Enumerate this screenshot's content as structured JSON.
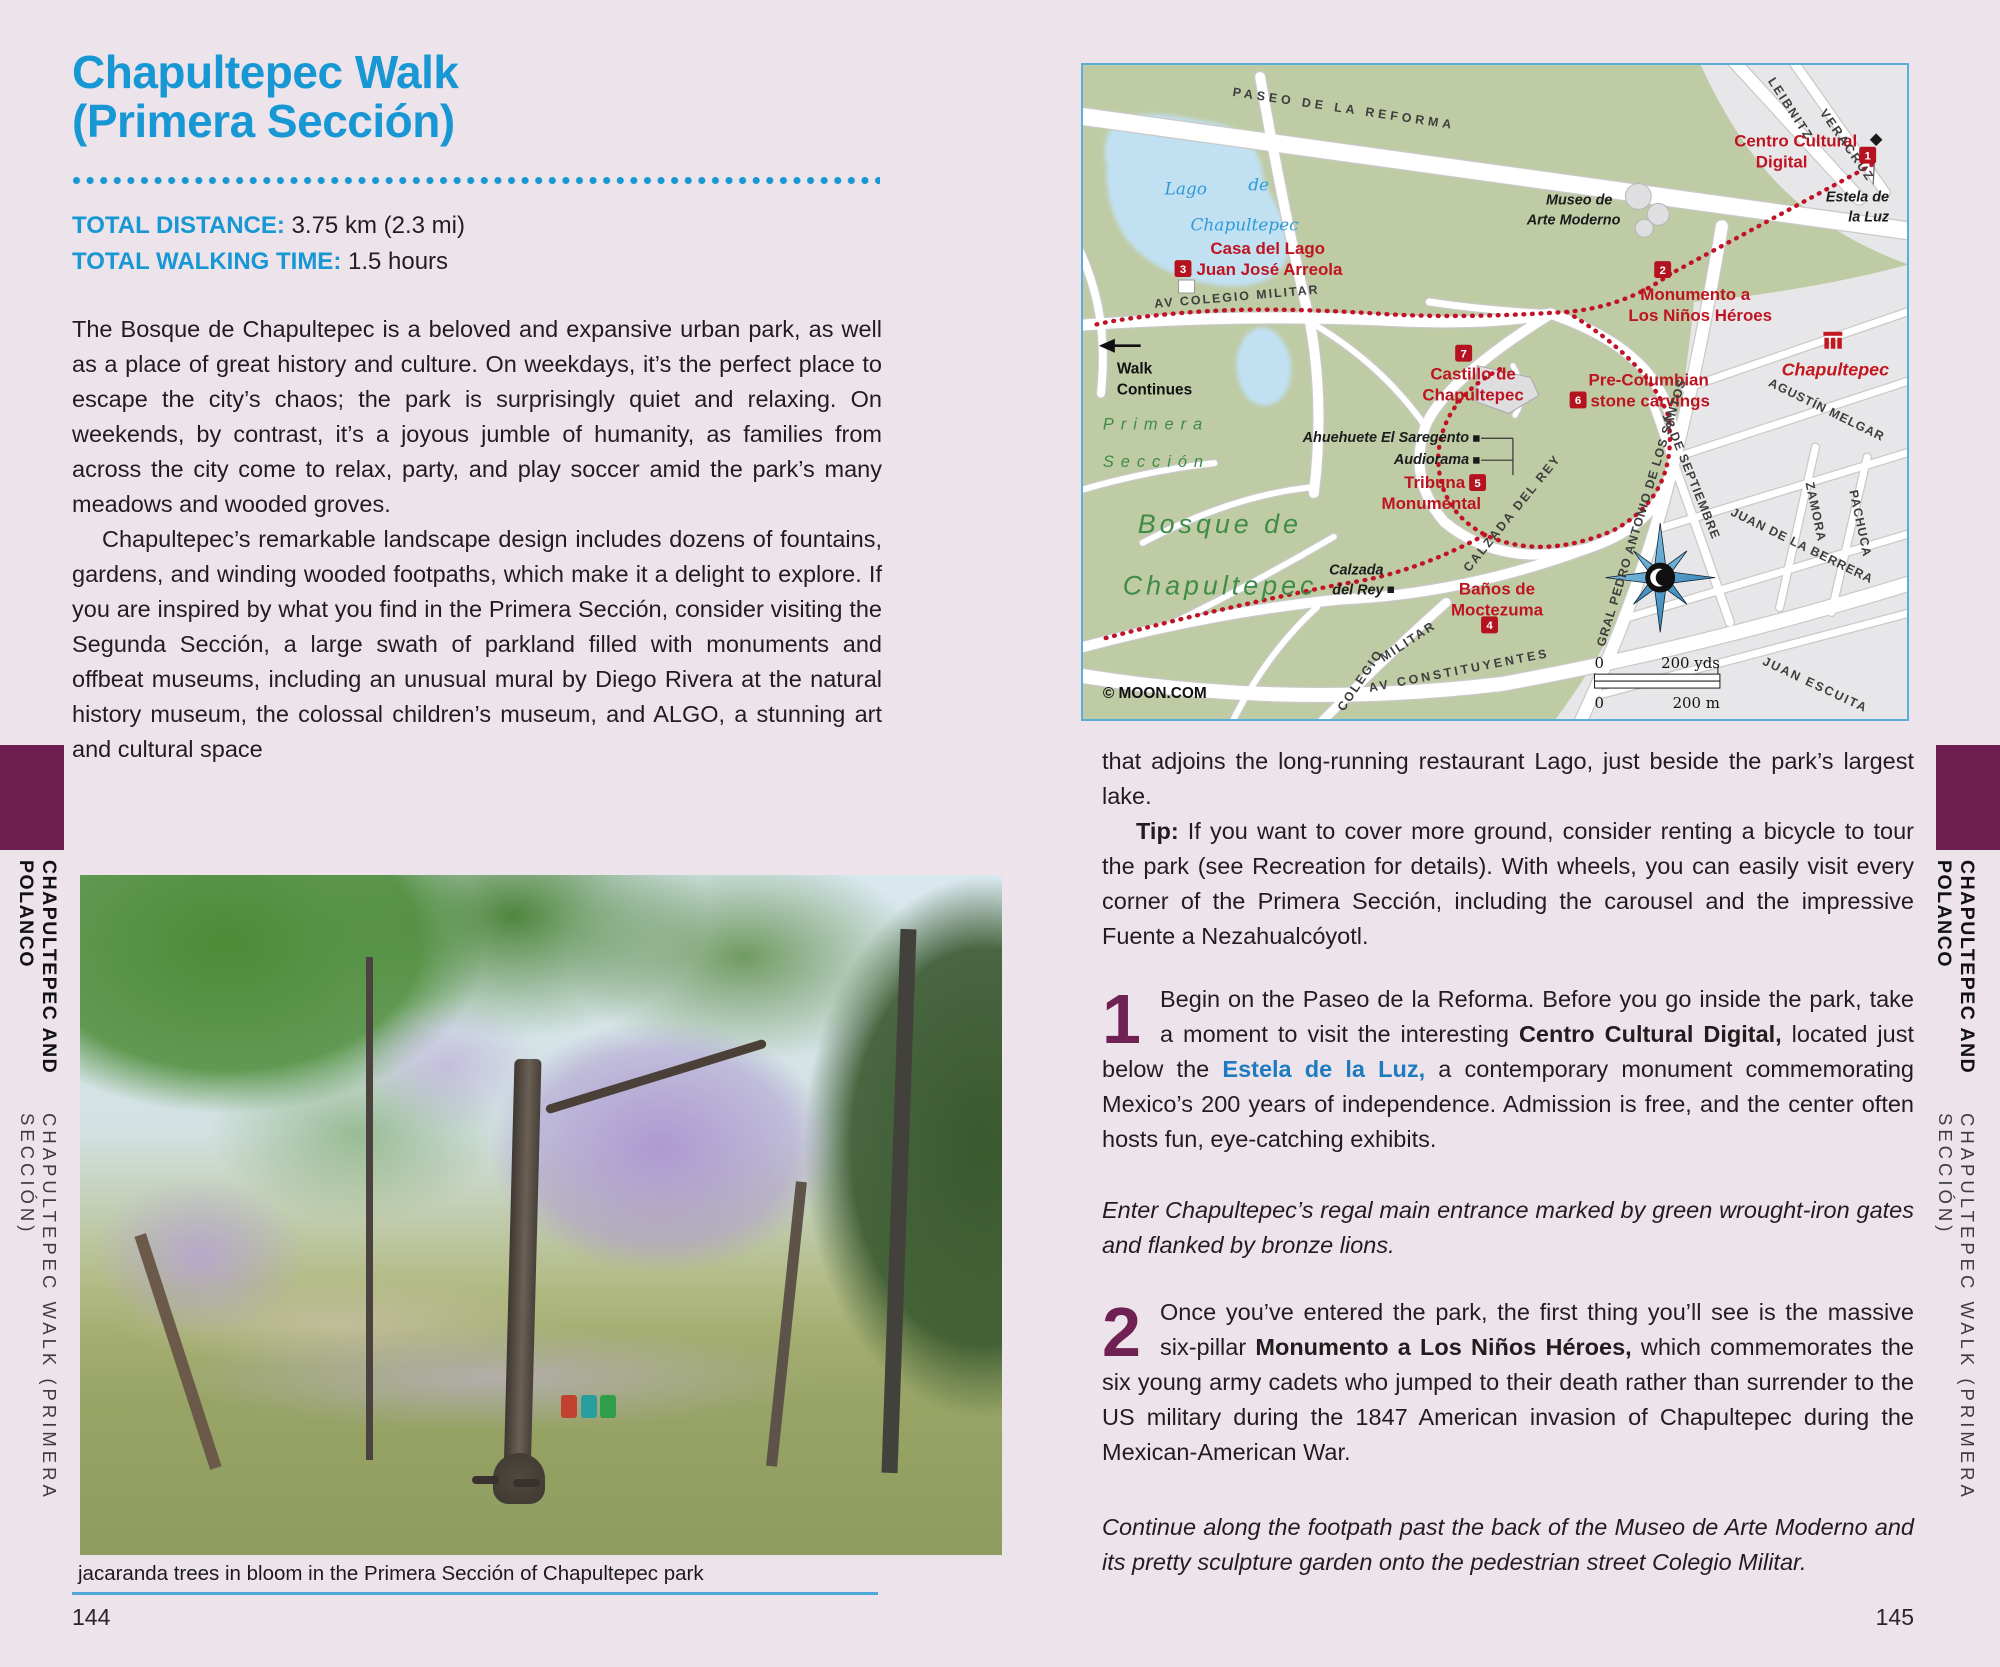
{
  "colors": {
    "page_background": "#EDE4EB",
    "accent_blue": "#1797D3",
    "link_blue": "#1E7BBF",
    "plum": "#6E1F52",
    "map_label_red": "#BE1421",
    "map_route_red": "#C01327",
    "map_border_blue": "#58AFD8",
    "map_park_green": "#BFCBA4",
    "caption_rule_blue": "#4FA8D8"
  },
  "band": {
    "bold": "CHAPULTEPEC AND POLANCO",
    "light": "CHAPULTEPEC WALK (PRIMERA SECCIÓN)"
  },
  "left": {
    "title1": "Chapultepec Walk",
    "title2": "(Primera Sección)",
    "stats": [
      {
        "label": "TOTAL DISTANCE:",
        "value": " 3.75 km (2.3 mi)"
      },
      {
        "label": "TOTAL WALKING TIME:",
        "value": " 1.5 hours"
      }
    ],
    "para1": "The Bosque de Chapultepec is a beloved and expansive urban park, as well as a place of great history and culture. On weekdays, it’s the perfect place to escape the city’s chaos; the park is surprisingly quiet and relaxing. On weekends, by contrast, it’s a joyous jumble of humanity, as families from across the city come to relax, party, and play soccer amid the park’s many meadows and wooded groves.",
    "para2": "Chapultepec’s remarkable landscape design includes dozens of fountains, gardens, and winding wooded footpaths, which make it a delight to explore. If you are inspired by what you find in the Primera Sección, consider visiting the Segunda Sección, a large swath of parkland filled with monuments and offbeat museums, including an unusual mural by Diego Rivera at the natural history museum, the colossal children’s museum, and ALGO, a stunning art and cultural space",
    "photo_caption": "jacaranda trees in bloom in the Primera Sección of Chapultepec park",
    "page_number": "144"
  },
  "right": {
    "para_continuation": "that adjoins the long-running restaurant Lago, just beside the park’s largest lake.",
    "tip_label": "Tip:",
    "tip_text": " If you want to cover more ground, consider renting a bicycle to tour the park (see Recreation for details). With wheels, you can easily visit every corner of the Primera Sección, including the carousel and the impressive Fuente a Nezahualcóyotl.",
    "steps": [
      {
        "number": "1",
        "pre": "Begin on the Paseo de la Reforma. Before you go inside the park, take a moment to visit the interesting ",
        "bold": "Centro Cultural Digital,",
        "mid": " located just below the ",
        "link": "Estela de la Luz,",
        "post": " a contemporary monument commemorating Mexico’s 200 years of independence. Admission is free, and the center often hosts fun, eye-catching exhibits."
      },
      {
        "number": "2",
        "pre": "Once you’ve entered the park, the first thing you’ll see is the massive six-pillar ",
        "bold": "Monumento a Los Niños Héroes,",
        "post": " which commemorates the six young army cadets who jumped to their death rather than surrender to the US military during the 1847 American invasion of Chapultepec during the Mexican-American War."
      }
    ],
    "italic1": "Enter Chapultepec’s regal main entrance marked by green wrought-iron gates and flanked by bronze lions.",
    "italic2": "Continue along the footpath past the back of the Museo de Arte Moderno and its pretty sculpture garden onto the pedestrian street Colegio Militar.",
    "page_number": "145"
  },
  "map": {
    "labels": [
      {
        "t": "PASEO   DE   LA   REFORMA",
        "x": 150,
        "y": 31,
        "c": "m-street",
        "r": 8.5,
        "ls": 4
      },
      {
        "t": "LEIBNITZ",
        "x": 688,
        "y": 16,
        "c": "m-street",
        "r": 57,
        "ls": 2
      },
      {
        "t": "Centro Cultural",
        "x": 778,
        "y": 82,
        "c": "m-red",
        "a": "end"
      },
      {
        "t": "Digital",
        "x": 728,
        "y": 103,
        "c": "m-red",
        "a": "end"
      },
      {
        "t": "Estela de",
        "x": 810,
        "y": 137,
        "c": "m-blkit",
        "a": "end"
      },
      {
        "t": "la Luz",
        "x": 810,
        "y": 157,
        "c": "m-blkit",
        "a": "end"
      },
      {
        "t": "Museo de",
        "x": 532,
        "y": 140,
        "c": "m-blkit",
        "a": "end"
      },
      {
        "t": "Arte Moderno",
        "x": 540,
        "y": 160,
        "c": "m-blkit",
        "a": "end"
      },
      {
        "t": "Lago",
        "x": 82,
        "y": 130,
        "c": "m-lake"
      },
      {
        "t": "de",
        "x": 166,
        "y": 126,
        "c": "m-lake"
      },
      {
        "t": "Chapultepec",
        "x": 108,
        "y": 166,
        "c": "m-lake"
      },
      {
        "t": "Casa del Lago",
        "x": 128,
        "y": 190,
        "c": "m-red"
      },
      {
        "t": "Juan José Arreola",
        "x": 114,
        "y": 211,
        "c": "m-red"
      },
      {
        "t": "AV  COLEGIO  MILITAR",
        "x": 72,
        "y": 244,
        "c": "m-street",
        "r": -5,
        "ls": 2
      },
      {
        "t": "Monumento a",
        "x": 560,
        "y": 236,
        "c": "m-red"
      },
      {
        "t": "Los Niños Héroes",
        "x": 548,
        "y": 257,
        "c": "m-red"
      },
      {
        "t": "Walk",
        "x": 34,
        "y": 310,
        "c": "m-blk"
      },
      {
        "t": "Continues",
        "x": 34,
        "y": 331,
        "c": "m-blk"
      },
      {
        "t": "Primera",
        "x": 20,
        "y": 366,
        "c": "m-green",
        "ls": 7
      },
      {
        "t": "Sección",
        "x": 20,
        "y": 404,
        "c": "m-green",
        "ls": 7
      },
      {
        "t": "Castillo de",
        "x": 392,
        "y": 316,
        "c": "m-red",
        "a": "middle"
      },
      {
        "t": "Chapultepec",
        "x": 392,
        "y": 337,
        "c": "m-red",
        "a": "middle"
      },
      {
        "t": "Pre-Columbian",
        "x": 508,
        "y": 322,
        "c": "m-red"
      },
      {
        "t": "stone carvings",
        "x": 510,
        "y": 343,
        "c": "m-red"
      },
      {
        "t": "Ahuehuete El Saregento",
        "x": 388,
        "y": 379,
        "c": "m-blkit",
        "a": "end"
      },
      {
        "t": "Audiorama",
        "x": 388,
        "y": 401,
        "c": "m-blkit",
        "a": "end"
      },
      {
        "t": "Tribuna",
        "x": 384,
        "y": 425,
        "c": "m-red",
        "a": "end"
      },
      {
        "t": "Monumental",
        "x": 400,
        "y": 446,
        "c": "m-red",
        "a": "end"
      },
      {
        "t": "Calzada",
        "x": 302,
        "y": 512,
        "c": "m-blkit",
        "a": "end"
      },
      {
        "t": "del Rey",
        "x": 302,
        "y": 532,
        "c": "m-blkit",
        "a": "end"
      },
      {
        "t": "CALZADA  DEL  REY",
        "x": 388,
        "y": 510,
        "c": "m-street",
        "r": -51,
        "ls": 2
      },
      {
        "t": "Baños de",
        "x": 416,
        "y": 532,
        "c": "m-red",
        "a": "middle"
      },
      {
        "t": "Moctezuma",
        "x": 416,
        "y": 553,
        "c": "m-red",
        "a": "middle"
      },
      {
        "t": "Bosque  de",
        "x": 55,
        "y": 470,
        "c": "m-biggreen",
        "ls": 4
      },
      {
        "t": "Chapultepec",
        "x": 40,
        "y": 532,
        "c": "m-biggreen",
        "ls": 4
      },
      {
        "t": "Chapultepec",
        "x": 810,
        "y": 312,
        "c": "m-redit",
        "a": "end"
      },
      {
        "t": "COLEGIO",
        "x": 262,
        "y": 650,
        "c": "m-street",
        "r": -56,
        "ls": 2
      },
      {
        "t": "MILITAR",
        "x": 302,
        "y": 600,
        "c": "m-street",
        "r": -33,
        "ls": 2
      },
      {
        "t": "AV    CONSTITUYENTES",
        "x": 288,
        "y": 630,
        "c": "m-street",
        "r": -11,
        "ls": 3
      },
      {
        "t": "GRAL PEDRO ANTONIO DE LOS SANTOS",
        "x": 524,
        "y": 585,
        "c": "m-street",
        "r": -73,
        "ls": 1
      },
      {
        "t": "13 DE SEPTIEMBRE",
        "x": 582,
        "y": 352,
        "c": "m-street",
        "r": 68,
        "ls": 1
      },
      {
        "t": "VERACRUZ",
        "x": 740,
        "y": 48,
        "c": "m-street",
        "r": 55,
        "ls": 2
      },
      {
        "t": "AGUSTÍN MELGAR",
        "x": 688,
        "y": 322,
        "c": "m-street",
        "r": 26,
        "ls": 1
      },
      {
        "t": "ZAMORA",
        "x": 726,
        "y": 420,
        "c": "m-street",
        "r": 78,
        "ls": 1
      },
      {
        "t": "PACHUCA",
        "x": 770,
        "y": 428,
        "c": "m-street",
        "r": 78,
        "ls": 1
      },
      {
        "t": "JUAN  DE LA BERRERA",
        "x": 650,
        "y": 452,
        "c": "m-street",
        "r": 26,
        "ls": 1
      },
      {
        "t": "JUAN   ESCUITA",
        "x": 682,
        "y": 602,
        "c": "m-street",
        "r": 25,
        "ls": 2
      },
      {
        "t": "© MOON.COM",
        "x": 20,
        "y": 636,
        "c": "m-blk"
      },
      {
        "t": "0",
        "x": 514,
        "y": 606,
        "c": "m-scale"
      },
      {
        "t": "200 yds",
        "x": 640,
        "y": 606,
        "c": "m-scale",
        "a": "end"
      },
      {
        "t": "0",
        "x": 514,
        "y": 646,
        "c": "m-scale"
      },
      {
        "t": "200 m",
        "x": 640,
        "y": 646,
        "c": "m-scale",
        "a": "end"
      }
    ],
    "markers": [
      {
        "n": "1",
        "x": 780,
        "y": 82
      },
      {
        "n": "2",
        "x": 574,
        "y": 197
      },
      {
        "n": "3",
        "x": 92,
        "y": 196
      },
      {
        "n": "4",
        "x": 400,
        "y": 554
      },
      {
        "n": "5",
        "x": 388,
        "y": 411
      },
      {
        "n": "6",
        "x": 489,
        "y": 328
      },
      {
        "n": "7",
        "x": 374,
        "y": 281
      }
    ]
  }
}
